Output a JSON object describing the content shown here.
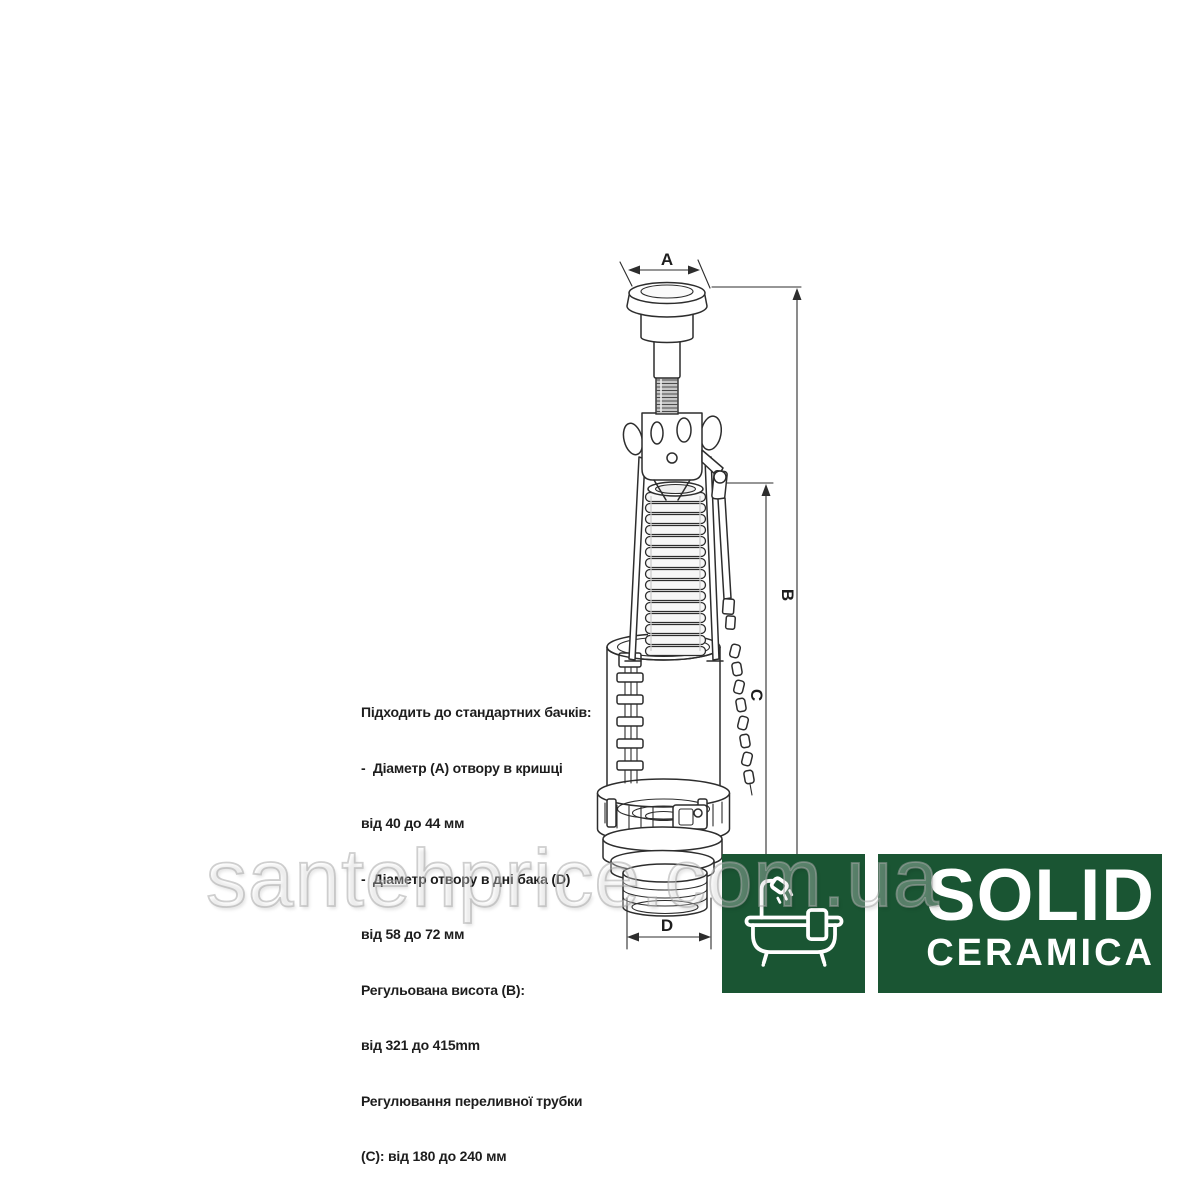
{
  "watermark": {
    "text": "santehprice.com.ua"
  },
  "specs": {
    "lines": [
      "Підходить до стандартних бачків:",
      "-  Діаметр (A) отвору в кришці",
      "від 40 до 44 мм",
      "-  Діаметр отвору в дні бака (D)",
      "від 58 до 72 мм",
      "Регульована висота (B):",
      "від 321 до 415mm",
      "Регулювання переливної трубки",
      "(C): від 180 до 240 мм"
    ]
  },
  "diagram": {
    "labels": {
      "a": "A",
      "b": "B",
      "c": "C",
      "d": "D"
    }
  },
  "logo": {
    "brand": "SOLID",
    "sub": "CERAMICA",
    "icon": "bathtub-shower-icon"
  },
  "colors": {
    "logo_green": "#1a5533",
    "logo_text": "#ffffff",
    "line_color": "#2d2d2d",
    "watermark_outline": "#a8a8a8"
  }
}
